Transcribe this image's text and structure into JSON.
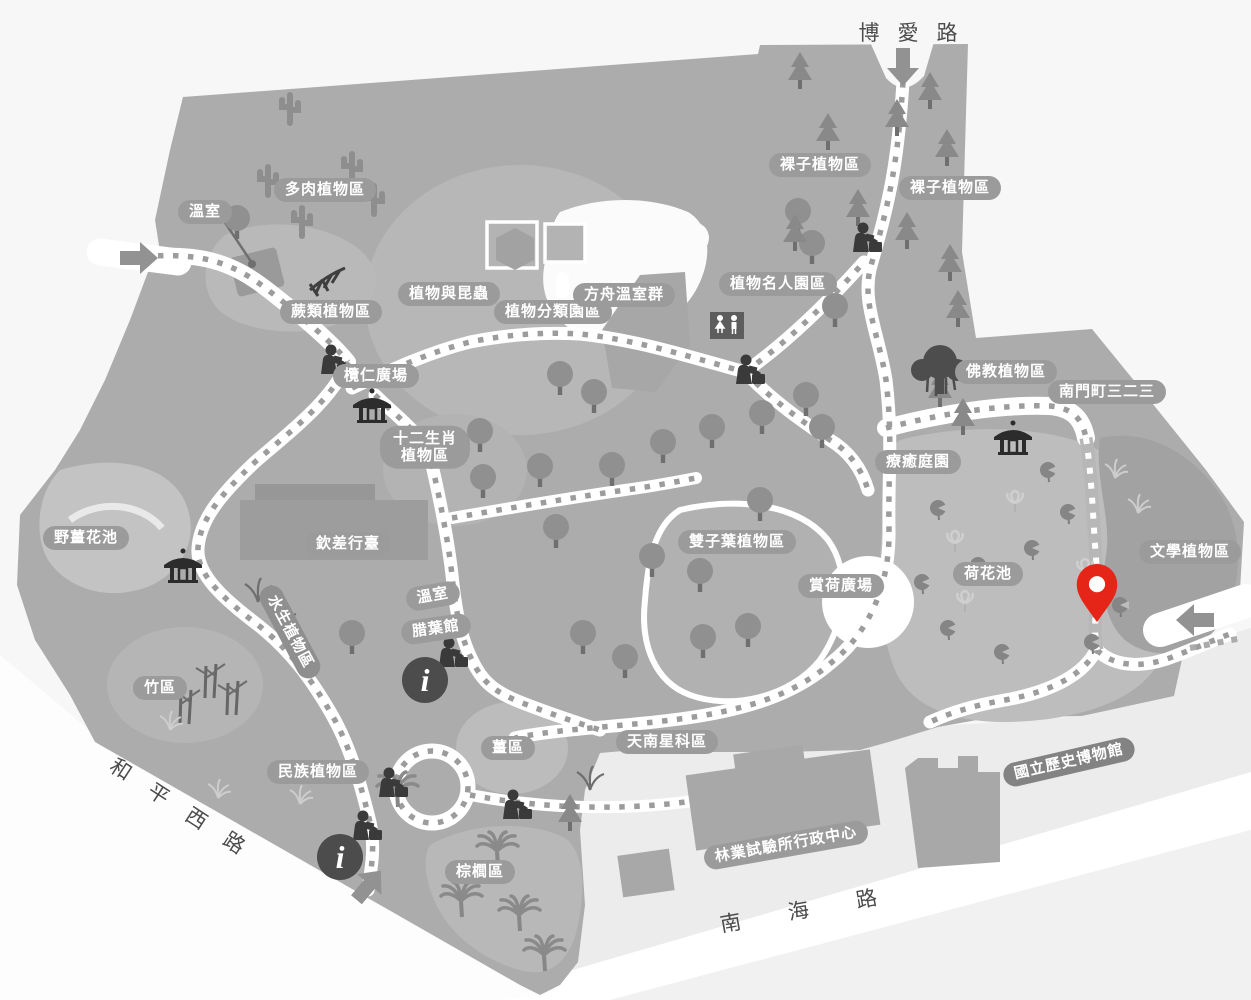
{
  "roads": {
    "top": "博愛路",
    "bottom": "南海路",
    "left": "和平西路"
  },
  "areas": {
    "greenhouse_nw": "溫室",
    "succulent": "多肉植物區",
    "fern": "蕨類植物區",
    "plants_insects": "植物與昆蟲",
    "classification": "植物分類園區",
    "ark_greenhouses": "方舟溫室群",
    "celebrities": "植物名人園區",
    "gymnosperm_w": "裸子植物區",
    "gymnosperm_e": "裸子植物區",
    "buddhist": "佛教植物區",
    "nanmen323": "南門町三二三",
    "terminalia_plaza": "欖仁廣場",
    "zodiac_line1": "十二生肖",
    "zodiac_line2": "植物區",
    "healing_garden": "療癒庭園",
    "ginger_lily_pond": "野薑花池",
    "qinchai_xingtai": "欽差行臺",
    "dicot": "雙子葉植物區",
    "lotus_plaza": "賞荷廣場",
    "lotus_pond": "荷花池",
    "literary": "文學植物區",
    "aquatic": "水生植物區",
    "greenhouse_c": "溫室",
    "herbarium": "腊葉館",
    "bamboo": "竹區",
    "ethnobotany": "民族植物區",
    "ginger": "薑區",
    "araceae": "天南星科區",
    "palm": "棕櫚區",
    "forestry_admin": "林業試驗所行政中心",
    "history_museum": "國立歷史博物館"
  },
  "icons": {
    "info_glyph": "i",
    "location_pin": "red-map-pin",
    "entrance_arrow": "gray-arrow",
    "pavilion": "pavilion",
    "statue": "statue",
    "restroom": "restroom"
  },
  "colors": {
    "page_bg": "#f7f7f7",
    "map_base": "#acacac",
    "label_pill": "#9b9b9b",
    "label_pill_dark": "#838383",
    "path_white": "#ffffff",
    "trail_dash": "#9c9c9c",
    "dark_icon": "#3a3a3a",
    "pin_red": "#e42518"
  }
}
